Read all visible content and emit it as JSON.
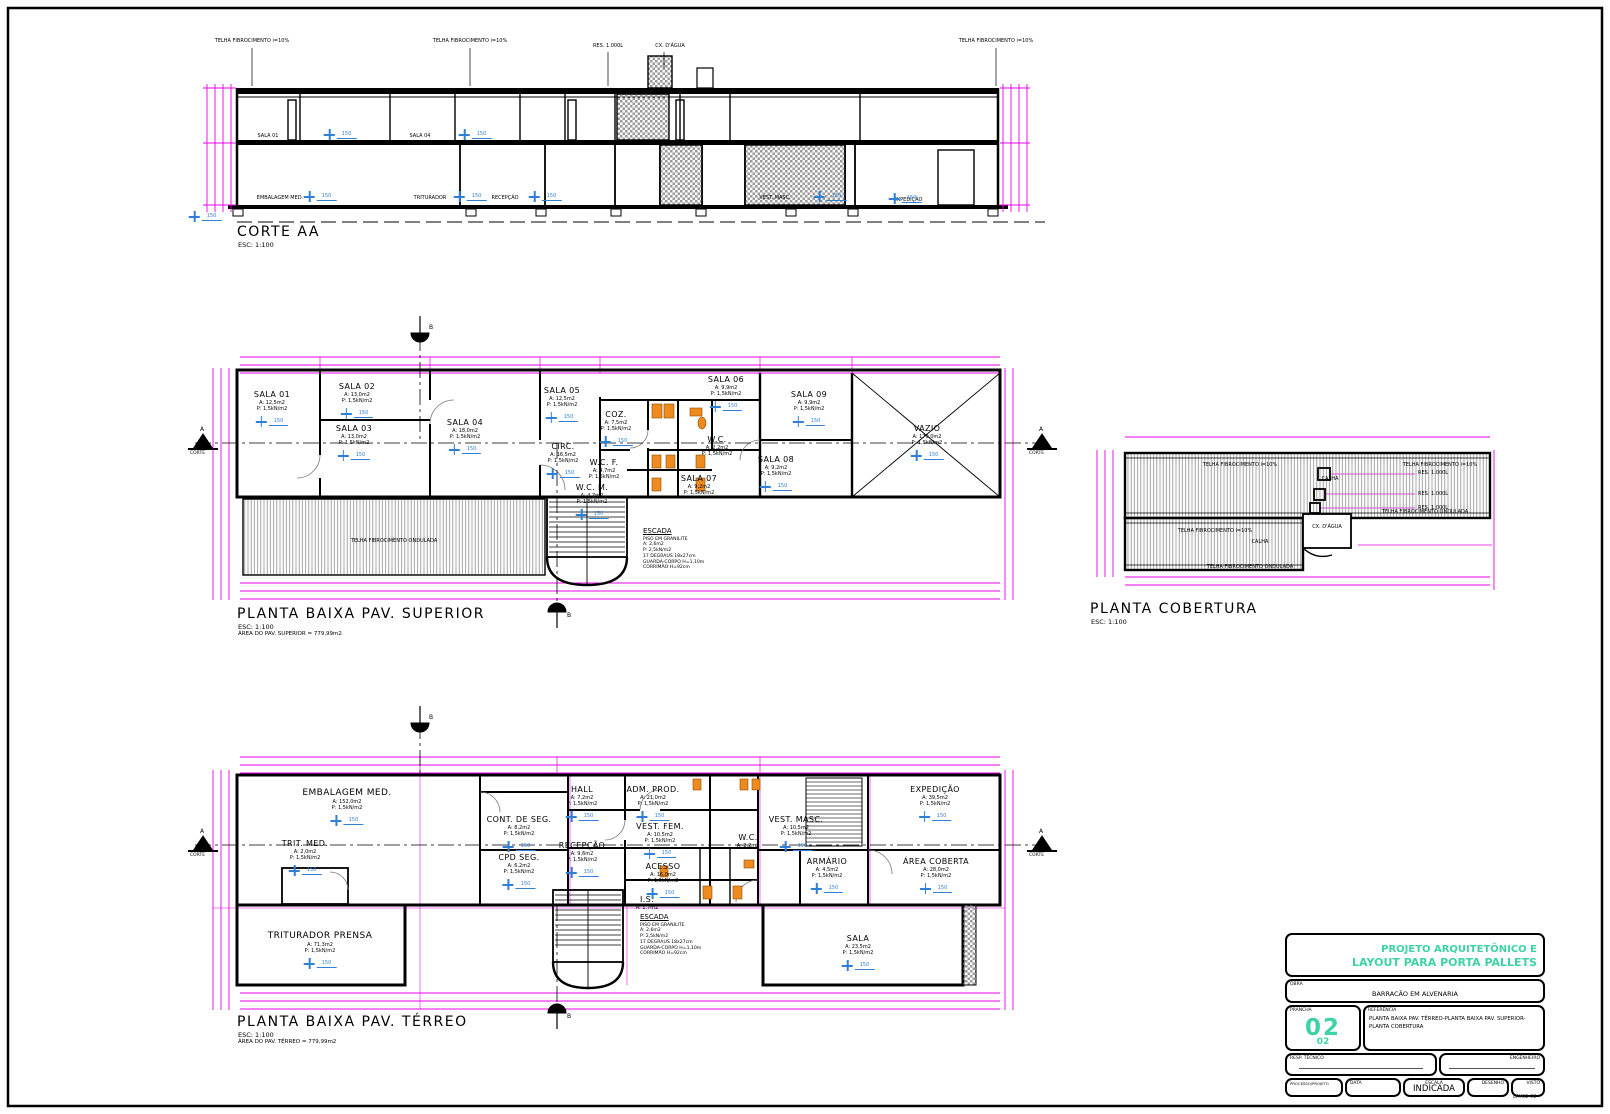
{
  "views": {
    "corte": {
      "title": "CORTE AA",
      "scale": "ESC: 1:100"
    },
    "superior": {
      "title": "PLANTA BAIXA PAV. SUPERIOR",
      "scale": "ESC: 1:100",
      "area_note": "ÁREA DO PAV. SUPERIOR = 779,99m2"
    },
    "cobertura": {
      "title": "PLANTA COBERTURA",
      "scale": "ESC: 1:100"
    },
    "terreo": {
      "title": "PLANTA BAIXA PAV. TÉRREO",
      "scale": "ESC: 1:100",
      "area_note": "ÁREA DO PAV. TÉRREO = 779,99m2"
    }
  },
  "symbols": {
    "level_tag": "150",
    "marker_a": "A",
    "marker_b": "B",
    "corte_label": "CORTE"
  },
  "labels": {
    "load_note": "P: 1,5kN/m2"
  },
  "notes": {
    "telha": "TELHA FIBROCIMENTO i=10%",
    "ondulada": "TELHA FIBROCIMENTO ONDULADA",
    "res": "RES. 1.000L",
    "cx": "CX. D'ÁGUA",
    "calha": "CALHA"
  },
  "escada_notes": {
    "hd": "ESCADA",
    "l1": "PISO EM GRANILITE",
    "l2": "A: 2,6m2",
    "l3": "P: 2,5kN/m2",
    "l4": "17 DEGRAUS 18x27cm",
    "l5": "GUARDA-CORPO H=1,10m",
    "l6": "CORRIMÃO H=92cm"
  },
  "rooms_superior": {
    "s01": {
      "nm": "SALA 01",
      "a": "A: 12,5m2"
    },
    "s02": {
      "nm": "SALA 02",
      "a": "A: 13,0m2"
    },
    "s03": {
      "nm": "SALA 03",
      "a": "A: 13,0m2"
    },
    "s04": {
      "nm": "SALA 04",
      "a": "A: 18,0m2"
    },
    "s05": {
      "nm": "SALA 05",
      "a": "A: 12,5m2"
    },
    "coz": {
      "nm": "COZ.",
      "a": "A: 7,5m2"
    },
    "circ": {
      "nm": "CIRC.",
      "a": "A: 16,5m2"
    },
    "wcf": {
      "nm": "W.C. F.",
      "a": "A: 4,7m2"
    },
    "wcm": {
      "nm": "W.C. M.",
      "a": "A: 4,7m2"
    },
    "wc": {
      "nm": "W.C.",
      "a": "A: 2,2m2"
    },
    "s06": {
      "nm": "SALA 06",
      "a": "A: 9,9m2"
    },
    "s09": {
      "nm": "SALA 09",
      "a": "A: 9,9m2"
    },
    "s08": {
      "nm": "SALA 08",
      "a": "A: 9,2m2"
    },
    "s07": {
      "nm": "SALA 07",
      "a": "A: 9,2m2"
    },
    "vazio": {
      "nm": "VAZIO",
      "a": "A: 170,0m2"
    }
  },
  "rooms_terreo": {
    "embalagem": {
      "nm": "EMBALAGEM MED.",
      "a": "A: 152,0m2"
    },
    "trit": {
      "nm": "TRIT. MED.",
      "a": "A: 2,0m2"
    },
    "cont": {
      "nm": "CONT. DE SEG.",
      "a": "A: 8,2m2"
    },
    "cpd": {
      "nm": "CPD SEG.",
      "a": "A: 6,2m2"
    },
    "recepcao": {
      "nm": "RECEPÇÃO",
      "a": "A: 9,6m2"
    },
    "hall": {
      "nm": "HALL",
      "a": "A: 7,2m2"
    },
    "adm": {
      "nm": "ADM. PROD.",
      "a": "A: 21,0m2"
    },
    "vestf": {
      "nm": "VEST. FEM.",
      "a": "A: 10,5m2"
    },
    "wc": {
      "nm": "W.C.",
      "a": "A: 2,2m2"
    },
    "vestm": {
      "nm": "VEST. MASC.",
      "a": "A: 10,5m2"
    },
    "acesso": {
      "nm": "ACESSO",
      "a": "A: 16,0m2"
    },
    "is": {
      "nm": "I.S.",
      "a": "A: 1,7m2"
    },
    "armario": {
      "nm": "ARMÁRIO",
      "a": "A: 4,5m2"
    },
    "areacoberta": {
      "nm": "ÁREA COBERTA",
      "a": "A: 28,0m2"
    },
    "expedicao": {
      "nm": "EXPEDIÇÃO",
      "a": "A: 39,5m2"
    },
    "triturador": {
      "nm": "TRITURADOR PRENSA",
      "a": "A: 71,3m2"
    },
    "sala": {
      "nm": "SALA",
      "a": "A: 23,5m2"
    }
  },
  "corte_labels": {
    "up1": "SALA 01",
    "up2": "SALA 04",
    "lo1": "EMBALAGEM MED.",
    "lo2": "TRITURADOR",
    "lo3": "RECEPÇÃO",
    "lo4": "VEST. MASC.",
    "lo5": "EXPEDIÇÃO"
  },
  "titleblock": {
    "title_line1": "PROJETO ARQUITETÔNICO E",
    "title_line2": "LAYOUT PARA PORTA PALLETS",
    "obra_label": "OBRA",
    "obra_value": "BARRACÃO EM ALVENARIA",
    "prancha_label": "PRANCHA",
    "prancha_number": "02",
    "prancha_total": "02",
    "referencia_label": "REFERÊNCIA",
    "referencia_line1": "PLANTA BAIXA PAV. TÉRREO-PLANTA BAIXA PAV. SUPERIOR-",
    "referencia_line2": "PLANTA COBERTURA",
    "resp_label": "RESP. TÉCNICO",
    "eng_label": "ENGENHEIRO",
    "processo_label": "PROCESSO/PROJETO",
    "data_label": "DATA",
    "escala_label": "ESCALA",
    "escala_value": "INDICADA",
    "desenho_label": "DESENHO",
    "visto_label": "VISTO",
    "file_note": "LAY02-02"
  }
}
